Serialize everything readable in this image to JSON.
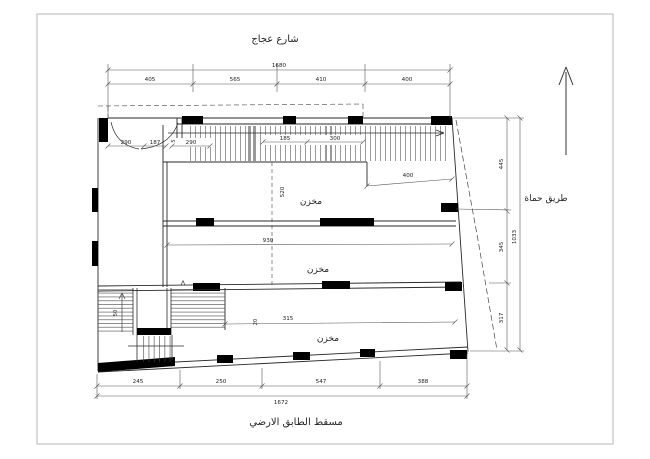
{
  "drawing": {
    "street_title": "شارع عجاج",
    "road_label": "طريق حماة",
    "caption": "مسقط الطابق الارضي",
    "rooms": [
      {
        "label": "مخزن"
      },
      {
        "label": "مخزن"
      },
      {
        "label": "مخزن"
      }
    ],
    "marker": "Λ",
    "colors": {
      "line": "#2a2a2a",
      "column": "#000000",
      "frame": "#b5b5b5",
      "background": "#ffffff",
      "hatch": "#555555",
      "band": "#9a9a9a"
    },
    "dimensions": {
      "top": {
        "total": "1680",
        "segments": [
          "405",
          "565",
          "410",
          "400"
        ]
      },
      "bottom": {
        "total": "1672",
        "segments": [
          "245",
          "250",
          "547",
          "388"
        ]
      },
      "right": {
        "total": "1033",
        "segments": [
          "445",
          "345",
          "317"
        ]
      },
      "interior": {
        "offset": "400",
        "room1_width": "930",
        "room1_depth": "520",
        "ramp": "290",
        "ramp_note": "5",
        "ramp_seg1": "185",
        "ramp_seg2": "300",
        "door_seg1": "290",
        "door_seg2": "187",
        "room3_width": "315",
        "room3_note": "20",
        "stair": "50"
      }
    }
  }
}
